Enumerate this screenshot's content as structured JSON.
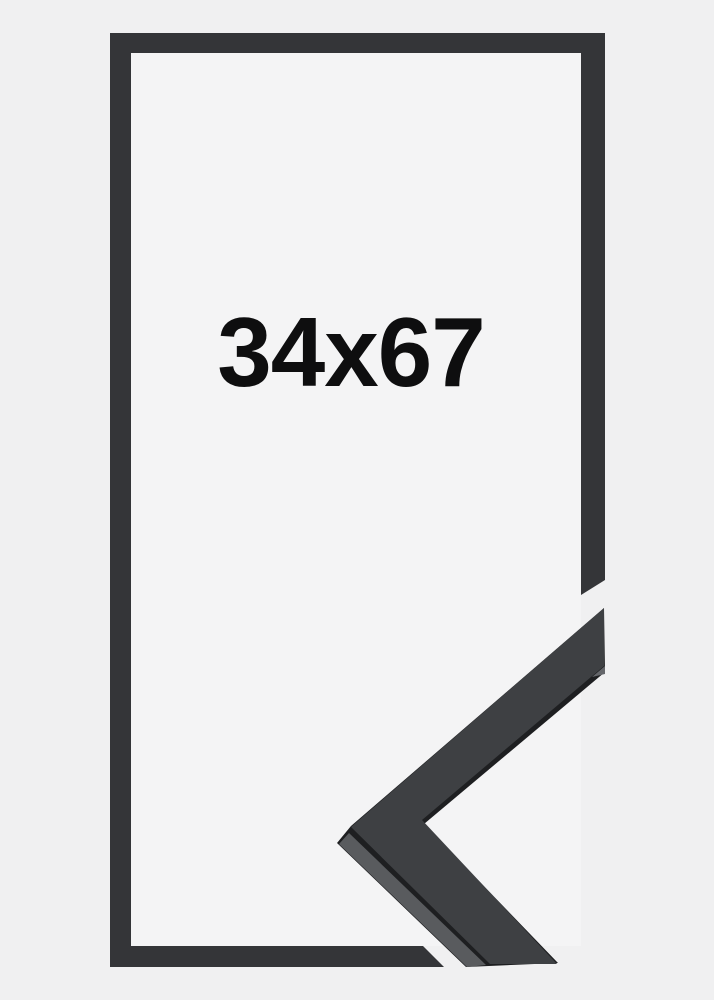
{
  "product": {
    "size_label": "34x67"
  },
  "icons": {
    "frame_corner": "picture-frame-corner-profile"
  },
  "colors": {
    "background": "#f0f0f1",
    "interior": "#f4f4f5",
    "border": "#343538",
    "face": "#3e4043",
    "edge_dark": "#1e1f21",
    "strip_gray": "#595b5e",
    "chamfer": "#64666a",
    "text": "#0e0e0f"
  }
}
